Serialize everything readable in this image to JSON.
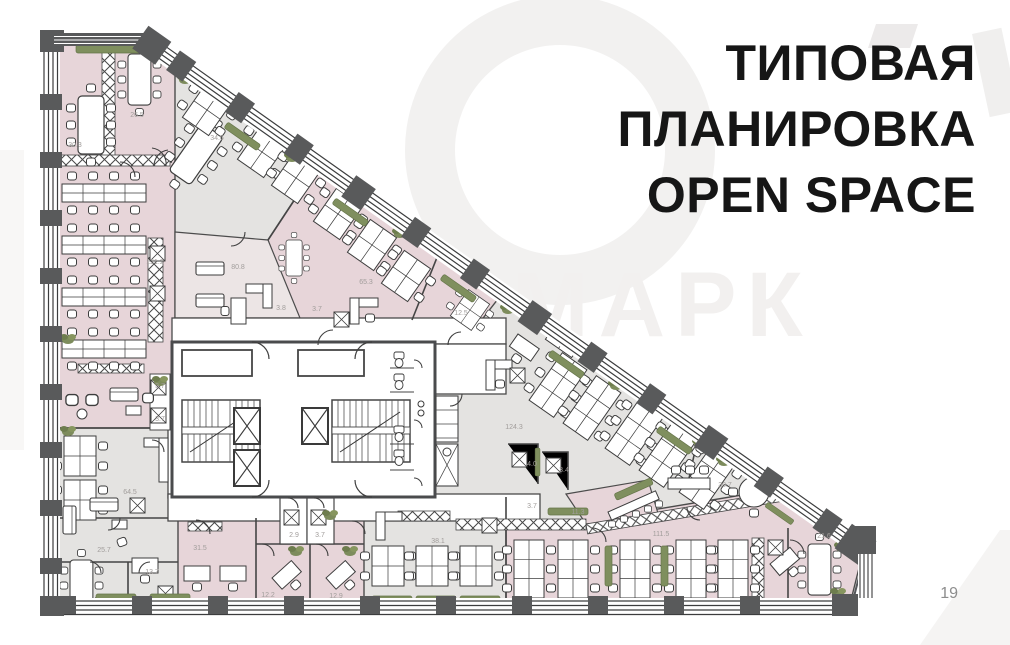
{
  "page": {
    "title_lines": [
      "ТИПОВАЯ",
      "ПЛАНИРОВКА",
      "OPEN SPACE"
    ],
    "page_number": "19"
  },
  "watermark": {
    "text": "МАРК"
  },
  "floor_plan": {
    "colors": {
      "room_pink": "#e7d5d9",
      "room_gray": "#e4e3e1",
      "room_pale": "#ece5e5",
      "wall_dark": "#58595b",
      "wall_line": "#454545",
      "plant_green": "#7d8c5c",
      "area_label": "#a19d9b"
    },
    "rooms": [
      {
        "id": "meeting-room-top-left",
        "area": "30.3"
      },
      {
        "id": "meeting-room-top",
        "area": "26.5"
      },
      {
        "id": "office-top-center",
        "area": "34.6"
      },
      {
        "id": "open-space-left",
        "area": "121.2"
      },
      {
        "id": "lounge-center",
        "area": "80.8"
      },
      {
        "id": "storage-center-a",
        "area": "3.8"
      },
      {
        "id": "storage-center-b",
        "area": "3.7"
      },
      {
        "id": "office-diagonal",
        "area": "65.3"
      },
      {
        "id": "meeting-small-right",
        "area": "12.5"
      },
      {
        "id": "open-space-center",
        "area": "124.3"
      },
      {
        "id": "pantry",
        "area": "4.0"
      },
      {
        "id": "storage-pantry",
        "area": "3.4"
      },
      {
        "id": "storage-below-pantry",
        "area": "3.7"
      },
      {
        "id": "lounge-right",
        "area": "30.7"
      },
      {
        "id": "coffee-point",
        "area": "11.3"
      },
      {
        "id": "open-space-bottom",
        "area": "111.5"
      },
      {
        "id": "meeting-room-right",
        "area": "21.6"
      },
      {
        "id": "open-space-bottom-left",
        "area": "38.1"
      },
      {
        "id": "office-left-lower",
        "area": "64.5"
      },
      {
        "id": "lounge-left",
        "area": "25.7"
      },
      {
        "id": "office-small-left",
        "area": "13.7"
      },
      {
        "id": "office-bottom-a",
        "area": "31.5"
      },
      {
        "id": "storage-bottom-a",
        "area": "2.9"
      },
      {
        "id": "storage-bottom-b",
        "area": "3.7"
      },
      {
        "id": "office-bottom-b",
        "area": "12.2"
      },
      {
        "id": "office-bottom-c",
        "area": "12.9"
      },
      {
        "id": "storage-left-a",
        "area": "3.7"
      },
      {
        "id": "storage-left-b",
        "area": "3.7"
      }
    ]
  }
}
